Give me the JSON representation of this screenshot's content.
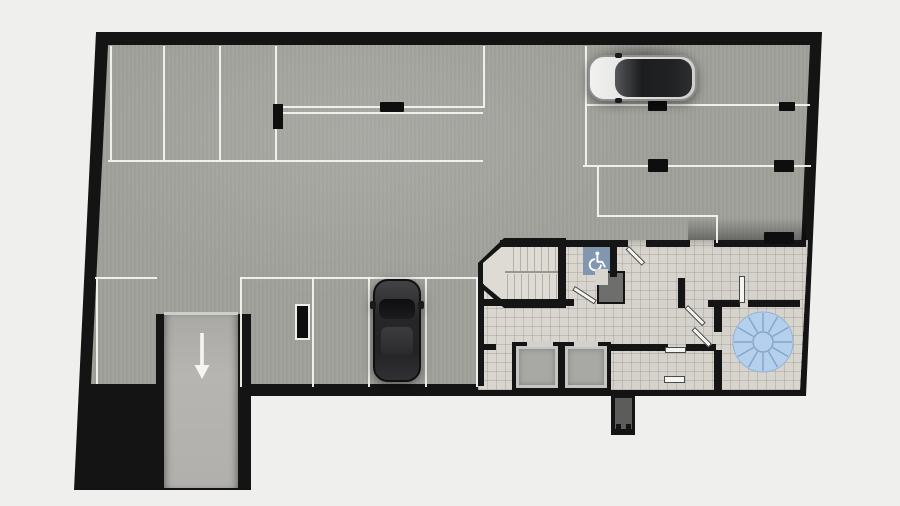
{
  "scene": {
    "type": "floor-plan",
    "view": "top-down 2D architectural render",
    "level_description": "underground parking level with driving aisle, down ramp, stairwell, two elevators and utility rooms",
    "background_color": "#efefed"
  },
  "palette": {
    "wall_black": "#151515",
    "parking_floor_gray": "#a0a09b",
    "ramp_floor_gray": "#b2b1ad",
    "core_tile_floor": "#d8d5cf",
    "stair_floor": "#dedbd5",
    "marking_line_white": "#f3f3f0",
    "accessible_badge_blue": "#8197af",
    "turntable_blue": "#b5d0ec",
    "turntable_spoke_blue": "#84a4c8",
    "car_dark_gray": "#232325",
    "car_silver": "#e6e6e4"
  },
  "icons": {
    "ramp_arrow_glyph": "↓",
    "ramp_arrow_label": "ramp-down direction arrow",
    "accessible_symbol_glyph": "♿",
    "accessible_symbol_label": "accessible parking symbol",
    "turntable_label": "circular turntable / fan element"
  },
  "features": {
    "parked_cars": 2,
    "elevator_shafts": 2,
    "stairwells": 1,
    "ramp_lanes": 1,
    "accessible_badges": 1,
    "turntables": 1,
    "wheel_stop_blocks": 6,
    "columns": 2
  }
}
